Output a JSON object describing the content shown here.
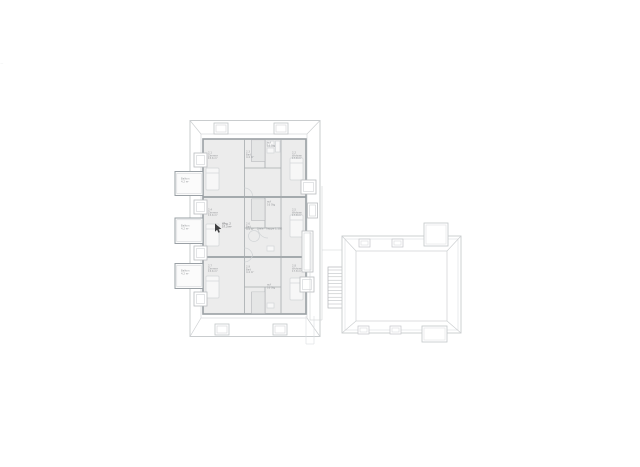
{
  "page": {
    "background": "#ffffff",
    "description": "Architectural attic floor / roof plan: three-unit main building with balconies and an adjacent hipped-roof annex"
  },
  "colors": {
    "roof_outline": "#c9ccce",
    "eave_line": "#d6d8da",
    "wall": "#9aa0a4",
    "wall_dark": "#898d90",
    "room_fill": "#ececec",
    "furniture": "#d2d5d7",
    "stair": "#b2b5b8",
    "label_text": "#97999c",
    "cursor": "#3f4042"
  },
  "labels": {
    "edge_mark": "·—",
    "balcony_1": "Balkon\n4.2 m²",
    "balcony_2": "Balkon\n4.2 m²",
    "balcony_3": "Balkon\n4.2 m²",
    "u1_room_left": "2.1\nZimmer\n15.6 m²",
    "u1_bath": "2.3\nBad\n4.4 m²",
    "u1_stair": "auf\n16 Stg",
    "u1_room_right": "2.2\nWohnen\n17.8 m²",
    "u2_room_left": "2.4\nZimmer\n15.6 m²",
    "u2_stair": "auf\n16 Stg",
    "u2_bath": "2.6\nBad\n4.4 m²",
    "u2_hall": "Diele · Treppe 1:100",
    "u2_room_right": "2.5\nWohnen\n17.8 m²",
    "u3_room_left": "2.7\nZimmer\n15.6 m²",
    "u3_bath": "2.9\nBad\n4.4 m²",
    "u3_stair": "auf\n16 Stg",
    "u3_room_right": "2.8\nWohnen\n17.8 m²",
    "cursor_tag": "Whg. 2\n57.3 m²"
  }
}
